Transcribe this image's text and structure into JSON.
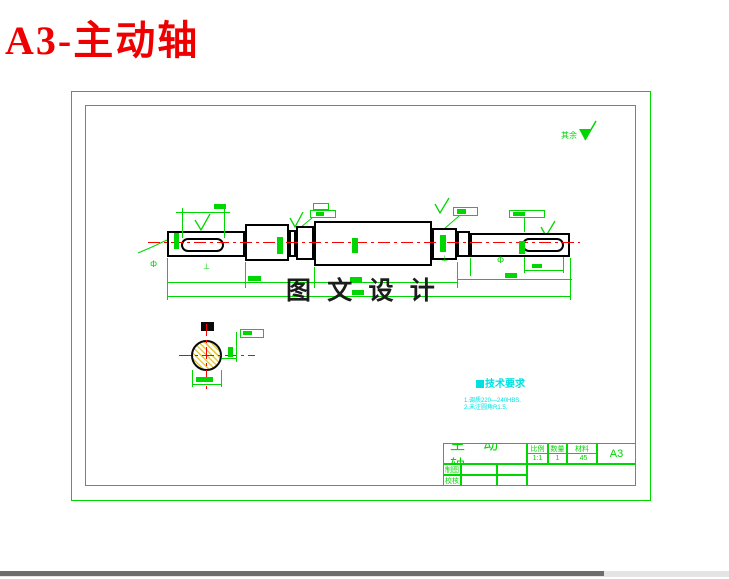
{
  "window": {
    "title": "A3-主动轴"
  },
  "colors": {
    "line_green": "#00d600",
    "centerline_red": "#ff0000",
    "tech_cyan": "#00e0e0",
    "title_red": "#ee0000",
    "hatch_yellow": "#e6cf3e"
  },
  "drawing": {
    "watermark": "图 文 设 计",
    "surface_finish_note": "其余",
    "symbols": {
      "phi": "Φ",
      "perp": "⊥"
    },
    "tech_requirements": {
      "heading": "技术要求",
      "items": [
        "1.调质220—240HBS.",
        "2.未注圆角R1.5."
      ]
    },
    "title_block": {
      "part_name": "主 动 轴",
      "scale_label": "比例",
      "scale_value": "1:1",
      "quantity_label": "数量",
      "quantity_value": "1",
      "material_label": "材料",
      "material_value": "45",
      "sheet_size": "A3",
      "drawn_by_label": "制图",
      "checked_by_label": "校核"
    }
  }
}
